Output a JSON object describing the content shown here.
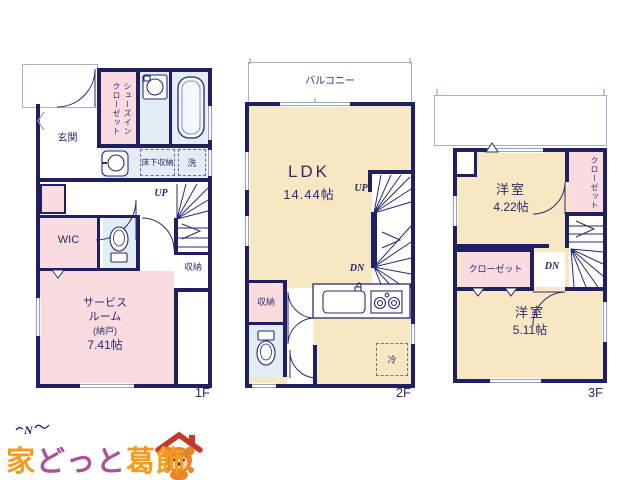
{
  "f1": {
    "floor_label": "1F",
    "genkan": "玄関",
    "sic": "シューズインクローゼット",
    "yukashita": "床下収納",
    "laundry": "洗",
    "wic": "WIC",
    "up": "UP",
    "storage": "収納",
    "service1": "サービス",
    "service2": "ルーム",
    "service3": "(納戸)",
    "service4": "7.41帖"
  },
  "f2": {
    "floor_label": "2F",
    "balcony": "バルコニー",
    "ldk": "LDK",
    "ldk_size": "14.44帖",
    "up": "UP",
    "dn": "DN",
    "storage": "収納",
    "fridge": "冷"
  },
  "f3": {
    "floor_label": "3F",
    "room1": "洋室",
    "room1_size": "4.22帖",
    "closet_v": "クローゼット",
    "closet_h": "クローゼット",
    "dn": "DN",
    "room2": "洋室",
    "room2_size": "5.11帖"
  },
  "logo": {
    "p1": "家",
    "p2": "どっと",
    "p3": "葛飾"
  },
  "compass": {
    "n": "N"
  },
  "colors": {
    "wall": "#201f63",
    "room_pink": "#fadce0",
    "room_cream": "#f8e7c3",
    "room_blue": "#e3edf5",
    "line_grey": "#9aa3c0",
    "text_navy": "#2b2a6e",
    "logo_orange": "#f59b1e",
    "logo_purple": "#a8539d",
    "mascot_red": "#c23b2a"
  }
}
